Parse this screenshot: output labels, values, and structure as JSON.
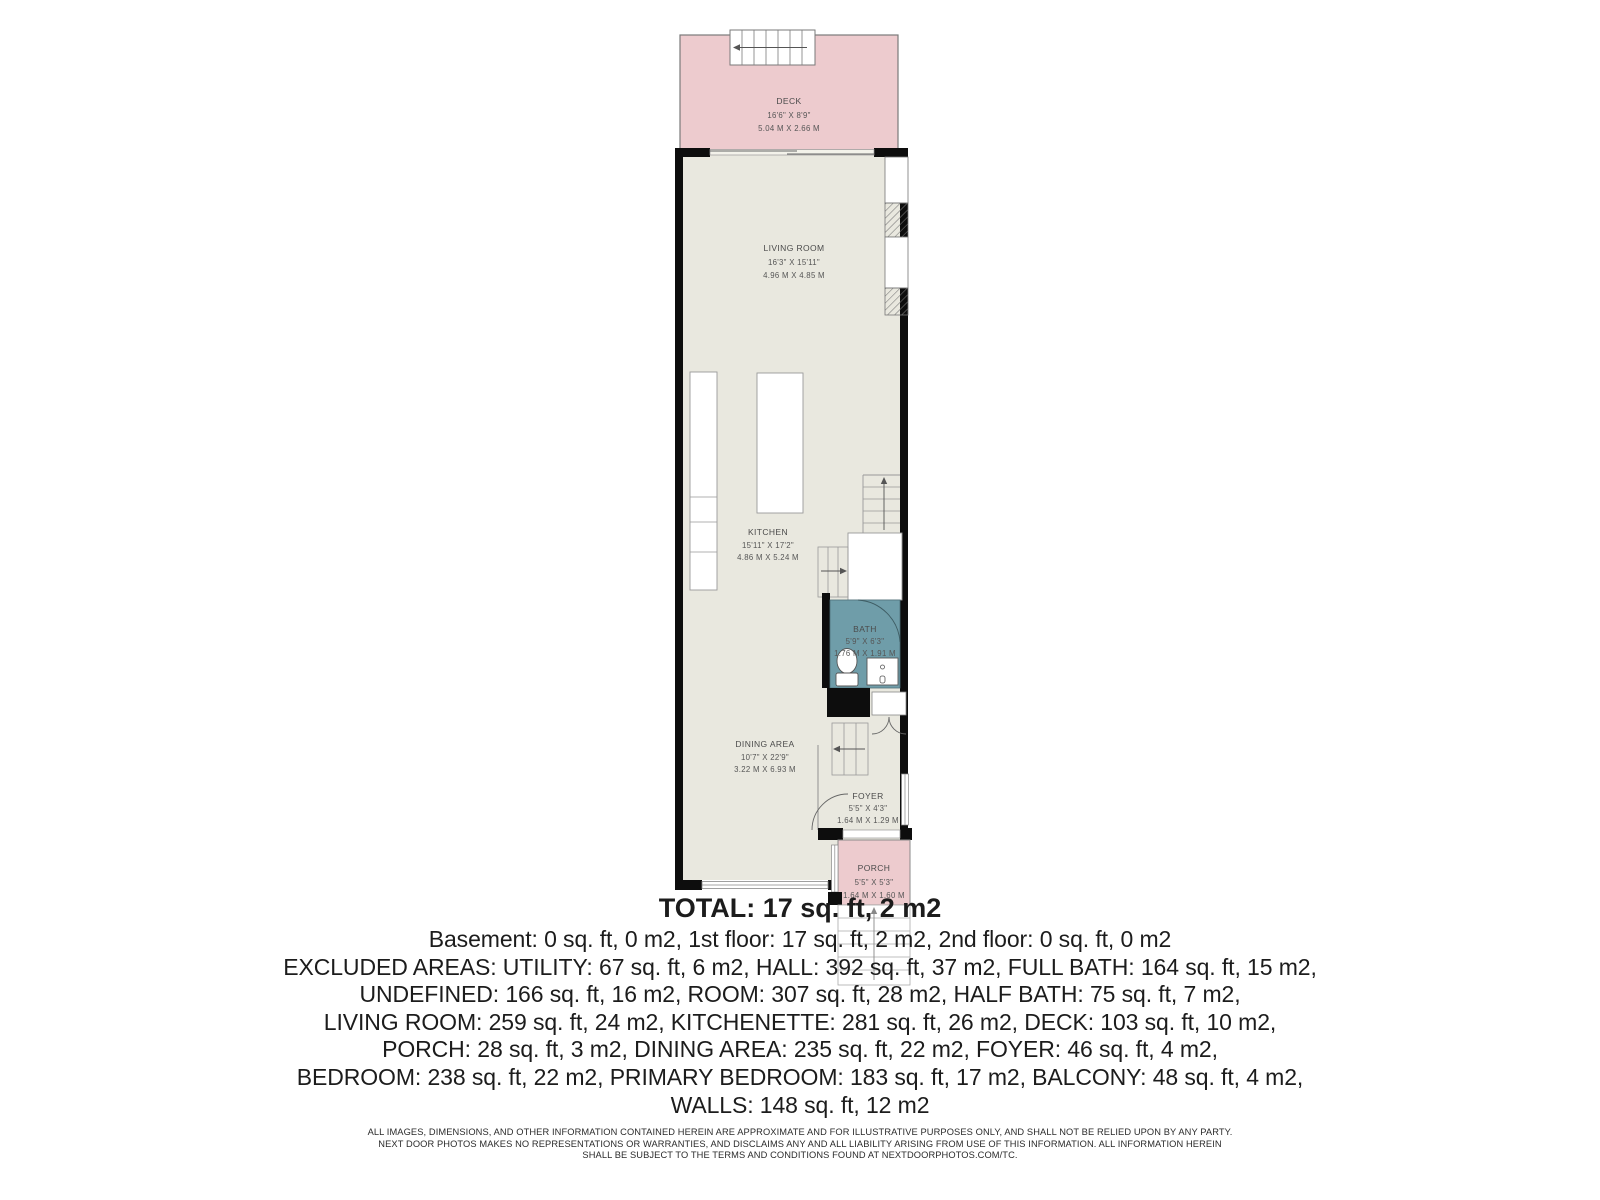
{
  "floorplan": {
    "rooms": {
      "deck": {
        "name": "DECK",
        "imperial": "16'6\" X 8'9\"",
        "metric": "5.04 M X 2.66 M"
      },
      "living_room": {
        "name": "LIVING ROOM",
        "imperial": "16'3\" X 15'11\"",
        "metric": "4.96 M X 4.85 M"
      },
      "kitchen": {
        "name": "KITCHEN",
        "imperial": "15'11\" X 17'2\"",
        "metric": "4.86 M X 5.24 M"
      },
      "bath": {
        "name": "BATH",
        "imperial": "5'9\" X 6'3\"",
        "metric": "1.76 M X 1.91 M"
      },
      "dining_area": {
        "name": "DINING AREA",
        "imperial": "10'7\" X 22'9\"",
        "metric": "3.22 M X 6.93 M"
      },
      "foyer": {
        "name": "FOYER",
        "imperial": "5'5\" X 4'3\"",
        "metric": "1.64 M X 1.29 M"
      },
      "porch": {
        "name": "PORCH",
        "imperial": "5'5\" X 5'3\"",
        "metric": "1.64 M X 1.60 M"
      }
    },
    "colors": {
      "deck_porch_fill": "#edcbce",
      "bath_fill": "#6f9da9",
      "floor_fill": "#e9e8df",
      "wall": "#0d0d0d"
    }
  },
  "summary": {
    "total": "TOTAL: 17 sq. ft, 2 m2",
    "lines": [
      "Basement: 0 sq. ft, 0 m2, 1st floor: 17 sq. ft, 2 m2, 2nd floor: 0 sq. ft, 0 m2",
      "EXCLUDED AREAS: UTILITY: 67 sq. ft, 6 m2, HALL: 392 sq. ft, 37 m2, FULL BATH: 164 sq. ft, 15 m2,",
      "UNDEFINED: 166 sq. ft, 16 m2, ROOM: 307 sq. ft, 28 m2, HALF BATH: 75 sq. ft, 7 m2,",
      "LIVING ROOM: 259 sq. ft, 24 m2, KITCHENETTE: 281 sq. ft, 26 m2, DECK: 103 sq. ft, 10 m2,",
      "PORCH: 28 sq. ft, 3 m2, DINING AREA: 235 sq. ft, 22 m2, FOYER: 46 sq. ft, 4 m2,",
      "BEDROOM: 238 sq. ft, 22 m2, PRIMARY BEDROOM: 183 sq. ft, 17 m2, BALCONY: 48 sq. ft, 4 m2,",
      "WALLS: 148 sq. ft, 12 m2"
    ]
  },
  "disclaimer": {
    "lines": [
      "ALL IMAGES, DIMENSIONS, AND OTHER INFORMATION CONTAINED HEREIN ARE APPROXIMATE AND FOR ILLUSTRATIVE PURPOSES ONLY, AND SHALL NOT BE RELIED UPON BY ANY PARTY.",
      "NEXT DOOR PHOTOS MAKES NO REPRESENTATIONS OR WARRANTIES, AND DISCLAIMS ANY AND ALL LIABILITY ARISING FROM USE OF THIS INFORMATION. ALL INFORMATION HEREIN",
      "SHALL BE SUBJECT TO THE TERMS AND CONDITIONS FOUND AT NEXTDOORPHOTOS.COM/TC."
    ]
  }
}
